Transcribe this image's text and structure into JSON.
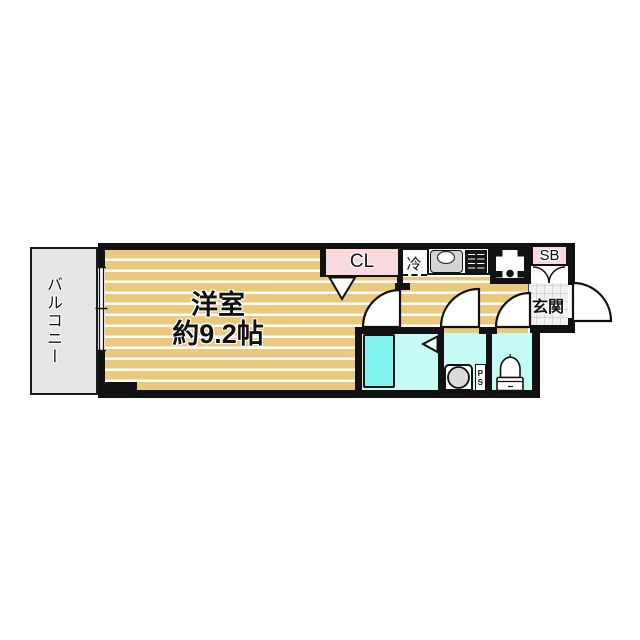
{
  "floorplan": {
    "balcony_label": "バルコニー",
    "main_room_label": "洋室",
    "main_room_area": "約9.2帖",
    "closet_label": "CL",
    "refrigerator_label": "冷",
    "shoebox_label": "SB",
    "entrance_label": "玄関",
    "pipe_space_p": "P",
    "pipe_space_s": "S",
    "colors": {
      "wall": "#111111",
      "floor_tan": "#EAC97C",
      "floor_stripe": "#FFFFFF",
      "closet_pink": "#FAD9DC",
      "room_cyan": "#C6FAF5",
      "bathtub_aqua": "#7FF3EC",
      "balcony_gray": "#E5E5E5",
      "entrance_tile": "#F1F1F1",
      "appliance_gray": "#D4D4D4"
    }
  }
}
